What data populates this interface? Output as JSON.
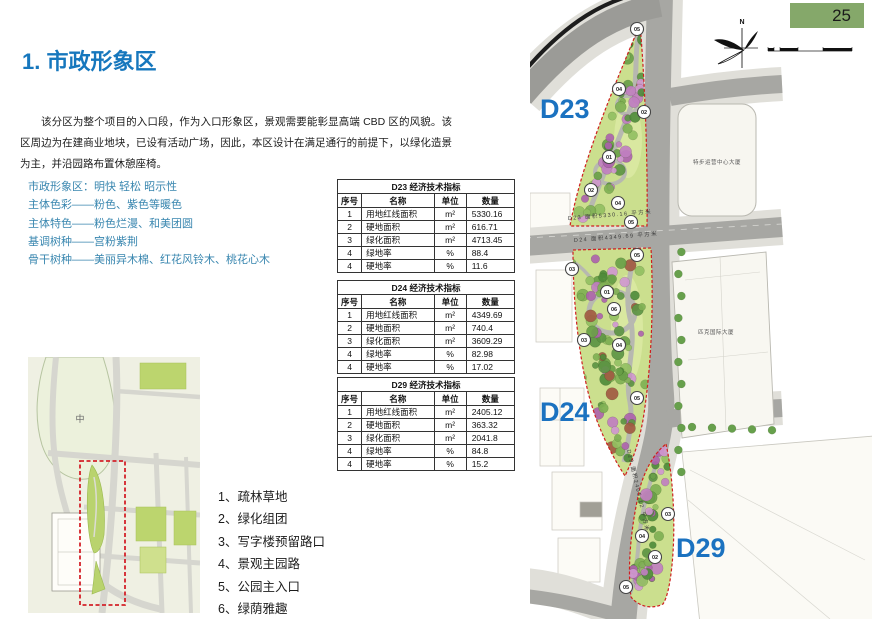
{
  "page": {
    "number": "25"
  },
  "title": "1. 市政形象区",
  "paragraph": "该分区为整个项目的入口段，作为入口形象区，景观需要能彰显高端 CBD 区的风貌。该区周边为在建商业地块，已设有活动广场，因此，本区设计在满足通行的前提下，以绿化造景为主，并沿园路布置休憩座椅。",
  "principles": [
    "市政形象区：明快 轻松 昭示性",
    "主体色彩——粉色、紫色等暖色",
    "主体特色——粉色烂漫、和美团圆",
    "基调树种——宫粉紫荆",
    "骨干树种——美丽异木棉、红花风铃木、桃花心木"
  ],
  "tables": [
    {
      "title": "D23 经济技术指标",
      "headers": [
        "序号",
        "名称",
        "单位",
        "数量"
      ],
      "rows": [
        [
          "1",
          "用地红线面积",
          "m²",
          "5330.16"
        ],
        [
          "2",
          "硬地面积",
          "m²",
          "616.71"
        ],
        [
          "3",
          "绿化面积",
          "m²",
          "4713.45"
        ],
        [
          "4",
          "绿地率",
          "%",
          "88.4"
        ],
        [
          "4",
          "硬地率",
          "%",
          "11.6"
        ]
      ]
    },
    {
      "title": "D24 经济技术指标",
      "headers": [
        "序号",
        "名称",
        "单位",
        "数量"
      ],
      "rows": [
        [
          "1",
          "用地红线面积",
          "m²",
          "4349.69"
        ],
        [
          "2",
          "硬地面积",
          "m²",
          "740.4"
        ],
        [
          "3",
          "绿化面积",
          "m²",
          "3609.29"
        ],
        [
          "4",
          "绿地率",
          "%",
          "82.98"
        ],
        [
          "4",
          "硬地率",
          "%",
          "17.02"
        ]
      ]
    },
    {
      "title": "D29 经济技术指标",
      "headers": [
        "序号",
        "名称",
        "单位",
        "数量"
      ],
      "rows": [
        [
          "1",
          "用地红线面积",
          "m²",
          "2405.12"
        ],
        [
          "2",
          "硬地面积",
          "m²",
          "363.32"
        ],
        [
          "3",
          "绿化面积",
          "m²",
          "2041.8"
        ],
        [
          "4",
          "绿地率",
          "%",
          "84.8"
        ],
        [
          "4",
          "硬地率",
          "%",
          "15.2"
        ]
      ]
    }
  ],
  "legend": [
    "1、疏林草地",
    "2、绿化组团",
    "3、写字楼预留路口",
    "4、景观主园路",
    "5、公园主入口",
    "6、绿荫雅趣"
  ],
  "map": {
    "zone_labels": [
      "D23",
      "D24",
      "D29"
    ],
    "area_labels": [
      "D23 面积5330.16 平方米",
      "D24 面积4349.69 平方米",
      "D29 面积2405.12 平方米"
    ],
    "buildings": [
      "特步运营中心大厦",
      "匹克国际大厦"
    ],
    "compass_n": "N",
    "plan_markers": [
      {
        "x": 107,
        "y": 29,
        "n": "05"
      },
      {
        "x": 89,
        "y": 89,
        "n": "04"
      },
      {
        "x": 114,
        "y": 112,
        "n": "02"
      },
      {
        "x": 79,
        "y": 157,
        "n": "01"
      },
      {
        "x": 61,
        "y": 190,
        "n": "02"
      },
      {
        "x": 88,
        "y": 203,
        "n": "04"
      },
      {
        "x": 101,
        "y": 222,
        "n": "05"
      },
      {
        "x": 107,
        "y": 255,
        "n": "05"
      },
      {
        "x": 42,
        "y": 269,
        "n": "03"
      },
      {
        "x": 77,
        "y": 292,
        "n": "01"
      },
      {
        "x": 84,
        "y": 309,
        "n": "06"
      },
      {
        "x": 54,
        "y": 340,
        "n": "03"
      },
      {
        "x": 89,
        "y": 345,
        "n": "04"
      },
      {
        "x": 107,
        "y": 398,
        "n": "05"
      },
      {
        "x": 138,
        "y": 514,
        "n": "03"
      },
      {
        "x": 112,
        "y": 536,
        "n": "04"
      },
      {
        "x": 125,
        "y": 557,
        "n": "02"
      },
      {
        "x": 96,
        "y": 587,
        "n": "05"
      }
    ]
  },
  "keymap": {
    "center_label": "中"
  },
  "colors": {
    "title_blue": "#1677bd",
    "principle_teal": "#3886af",
    "zone_label_blue": "#1b72c0",
    "page_badge_green": "#85a86a",
    "parcel_border_red": "#cf1f1f",
    "parcel_green": "#cbdf8e"
  }
}
